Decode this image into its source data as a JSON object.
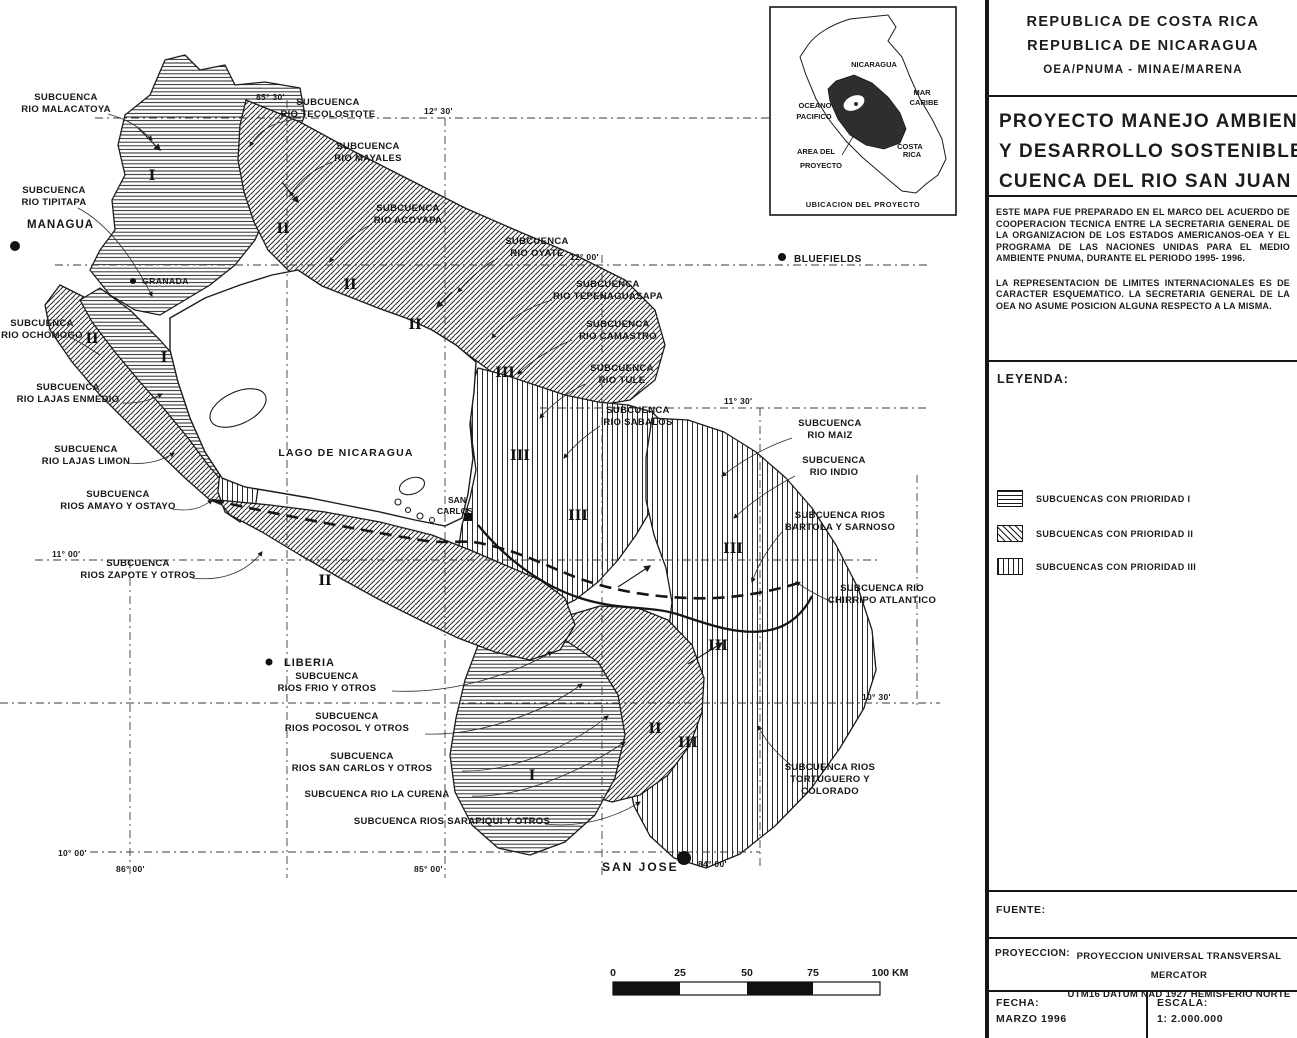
{
  "colors": {
    "ink": "#1c1c1c",
    "paper": "#ffffff",
    "inset_area_fill": "#2e2e2e"
  },
  "panel": {
    "header": {
      "country1": "REPUBLICA DE COSTA RICA",
      "country2": "REPUBLICA DE NICARAGUA",
      "orgs": "OEA/PNUMA - MINAE/MARENA"
    },
    "title": {
      "line1": "PROYECTO MANEJO AMBIENTAL",
      "line2": "Y DESARROLLO SOSTENIBLE",
      "line3": "CUENCA DEL RIO SAN JUAN"
    },
    "notes": {
      "para1": "ESTE MAPA FUE PREPARADO EN EL MARCO DEL ACUERDO DE COOPERACION TECNICA ENTRE LA SECRETARIA GENERAL DE LA ORGANIZACION DE LOS ESTADOS AMERICANOS-OEA Y EL PROGRAMA DE LAS NACIONES UNIDAS PARA EL MEDIO AMBIENTE PNUMA, DURANTE EL PERIODO 1995- 1996.",
      "para2": "LA REPRESENTACION DE LIMITES INTERNACIONALES ES DE CARACTER ESQUEMATICO. LA SECRETARIA GENERAL DE LA OEA NO ASUME POSICION ALGUNA RESPECTO A LA MISMA."
    },
    "legend": {
      "heading": "LEYENDA:",
      "items": [
        {
          "label": "SUBCUENCAS CON PRIORIDAD I",
          "pattern": "horizontal-lines"
        },
        {
          "label": "SUBCUENCAS CON PRIORIDAD II",
          "pattern": "diagonal-hatch"
        },
        {
          "label": "SUBCUENCAS CON PRIORIDAD III",
          "pattern": "vertical-lines"
        }
      ]
    },
    "fuente_label": "FUENTE:",
    "proyeccion": {
      "label": "PROYECCION:",
      "line1": "PROYECCION UNIVERSAL TRANSVERSAL MERCATOR",
      "line2": "UTM16 DATUM NAD 1927 HEMISFERIO NORTE"
    },
    "fecha": {
      "label": "FECHA:",
      "value": "MARZO 1996"
    },
    "escala": {
      "label": "ESCALA:",
      "value": "1: 2.000.000"
    }
  },
  "inset": {
    "nicaragua": "NICARAGUA",
    "mar1": "MAR",
    "mar2": "CARIBE",
    "oceano1": "OCEANO",
    "oceano2": "PACIFICO",
    "area1": "AREA DEL",
    "area2": "PROYECTO",
    "cr1": "COSTA",
    "cr2": "RICA",
    "caption": "UBICACION DEL PROYECTO"
  },
  "map": {
    "lake": "LAGO DE NICARAGUA",
    "cities": {
      "managua": "MANAGUA",
      "granada": "GRANADA",
      "liberia": "LIBERIA",
      "san_carlos1": "SAN",
      "san_carlos2": "CARLOS",
      "bluefields": "BLUEFIELDS",
      "san_jose": "SAN JOSE"
    },
    "grat": {
      "g85_30": "85° 30'",
      "g12_30": "12° 30'",
      "g12_00": "12° 00'",
      "g11_30": "11° 30'",
      "g11_00": "11° 00'",
      "g10_30": "10° 30'",
      "g10_00": "10° 00'",
      "g86_00": "86° 00'",
      "g85_00": "85° 00'",
      "g84_00": "84° 00'"
    },
    "marks": {
      "p1": "I",
      "p2": "II",
      "p3": "III"
    },
    "scalebar": {
      "t0": "0",
      "t25": "25",
      "t50": "50",
      "t75": "75",
      "t100": "100 KM"
    },
    "sub": {
      "malacatoya": {
        "l1": "SUBCUENCA",
        "l2": "RIO MALACATOYA"
      },
      "tipitapa": {
        "l1": "SUBCUENCA",
        "l2": "RIO TIPITAPA"
      },
      "ochomogo": {
        "l1": "SUBCUENCA",
        "l2": "RIO OCHOMOGO"
      },
      "lajas_enmedio": {
        "l1": "SUBCUENCA",
        "l2": "RIO LAJAS ENMEDIO"
      },
      "lajas_limon": {
        "l1": "SUBCUENCA",
        "l2": "RIO LAJAS LIMON"
      },
      "amayo_ostayo": {
        "l1": "SUBCUENCA",
        "l2": "RIOS AMAYO Y OSTAYO"
      },
      "zapote": {
        "l1": "SUBCUENCA",
        "l2": "RIOS ZAPOTE Y OTROS"
      },
      "tecolostote": {
        "l1": "SUBCUENCA",
        "l2": "RIO TECOLOSTOTE"
      },
      "mayales": {
        "l1": "SUBCUENCA",
        "l2": "RIO MAYALES"
      },
      "acoyapa": {
        "l1": "SUBCUENCA",
        "l2": "RIO ACOYAPA"
      },
      "oyate": {
        "l1": "SUBCUENCA",
        "l2": "RIO OYATE"
      },
      "tepenaguasapa": {
        "l1": "SUBCUENCA",
        "l2": "RIO TEPENAGUASAPA"
      },
      "camastro": {
        "l1": "SUBCUENCA",
        "l2": "RIO CAMASTRO"
      },
      "tule": {
        "l1": "SUBCUENCA",
        "l2": "RIO TULE"
      },
      "sabalos": {
        "l1": "SUBCUENCA",
        "l2": "RIO SABALOS"
      },
      "maiz": {
        "l1": "SUBCUENCA",
        "l2": "RIO MAIZ"
      },
      "indio": {
        "l1": "SUBCUENCA",
        "l2": "RIO INDIO"
      },
      "bartola_sarnoso": {
        "l1": "SUBCUENCA RIOS",
        "l2": "BARTOLA Y SARNOSO"
      },
      "chirripo": {
        "l1": "SUBCUENCA RIO",
        "l2": "CHIRRIPO ATLANTICO"
      },
      "frio": {
        "l1": "SUBCUENCA",
        "l2": "RIOS FRIO Y OTROS"
      },
      "pocosol": {
        "l1": "SUBCUENCA",
        "l2": "RIOS POCOSOL Y OTROS"
      },
      "san_carlos_otros": {
        "l1": "SUBCUENCA",
        "l2": "RIOS SAN CARLOS Y OTROS"
      },
      "curena": {
        "l1": "SUBCUENCA RIO LA CURENA"
      },
      "sarapiqui": {
        "l1": "SUBCUENCA RIOS SARAPIQUI Y OTROS"
      },
      "tortuguero": {
        "l1": "SUBCUENCA RIOS",
        "l2": "TORTUGUERO Y",
        "l3": "COLORADO"
      }
    }
  }
}
